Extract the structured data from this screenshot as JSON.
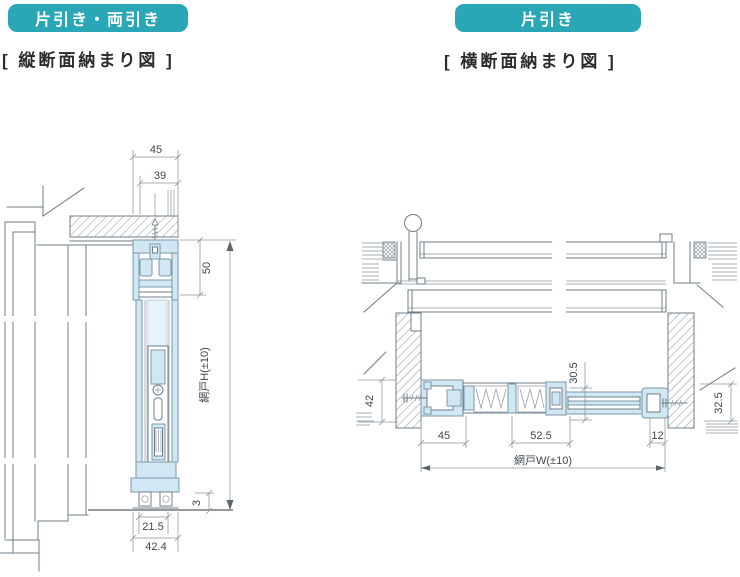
{
  "colors": {
    "badge_teal": "#2aa7b6",
    "badge_text": "#ffffff",
    "profile_fill": "#cfe8f4",
    "profile_fill_light": "#e6f3fa",
    "line_gray": "#6f7d88",
    "dimension_gray": "#8a959e",
    "text_dark": "#3f474d"
  },
  "left_section": {
    "badge_label": "片引き・両引き",
    "caption": "[ 縦断面納まり図 ]",
    "dimensions": {
      "outer_width": "45",
      "inner_width": "39",
      "head_height": "50",
      "screen_height": "網戸H(±10)",
      "bottom_clearance": "3",
      "sill_inner_width": "21.5",
      "sill_outer_width": "42.4"
    }
  },
  "right_section": {
    "badge_label": "片引き",
    "caption": "[ 横断面納まり図 ]",
    "dimensions": {
      "jamb_height": "42",
      "rail_depth": "30.5",
      "wall_offset": "32.5",
      "frame_width": "45",
      "pleat_width": "52.5",
      "end_gap": "12",
      "screen_width": "網戸W(±10)"
    }
  }
}
